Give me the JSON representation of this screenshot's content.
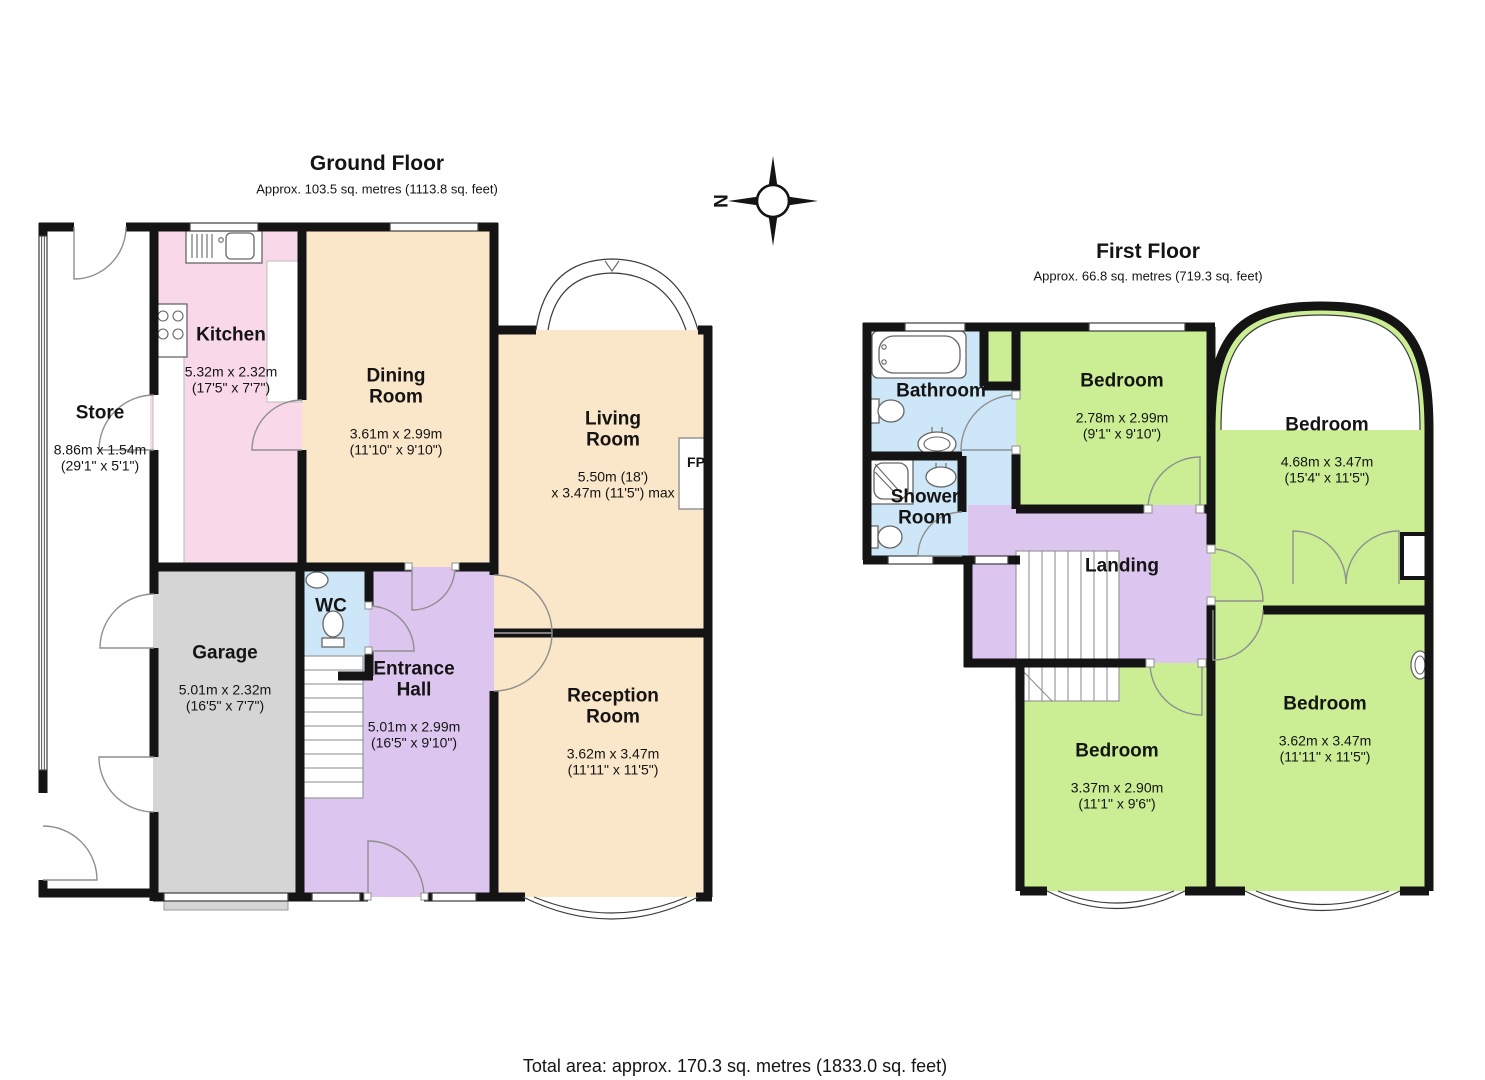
{
  "compass": {
    "north_label": "N"
  },
  "ground_floor": {
    "title": "Ground Floor",
    "subtitle": "Approx. 103.5 sq. metres (1113.8 sq. feet)",
    "rooms": {
      "store": {
        "name": "Store",
        "dims": "8.86m x 1.54m\n(29'1\" x 5'1\")"
      },
      "kitchen": {
        "name": "Kitchen",
        "dims": "5.32m x 2.32m\n(17'5\" x 7'7\")"
      },
      "dining_room": {
        "name": "Dining\nRoom",
        "dims": "3.61m x 2.99m\n(11'10\" x 9'10\")"
      },
      "living_room": {
        "name": "Living\nRoom",
        "dims": "5.50m (18')\nx 3.47m (11'5\") max"
      },
      "fireplace": {
        "name": "FP"
      },
      "garage": {
        "name": "Garage",
        "dims": "5.01m x 2.32m\n(16'5\" x 7'7\")"
      },
      "wc": {
        "name": "WC"
      },
      "entrance_hall": {
        "name": "Entrance\nHall",
        "dims": "5.01m x 2.99m\n(16'5\" x 9'10\")"
      },
      "reception_room": {
        "name": "Reception\nRoom",
        "dims": "3.62m x 3.47m\n(11'11\" x 11'5\")"
      }
    }
  },
  "first_floor": {
    "title": "First Floor",
    "subtitle": "Approx. 66.8 sq. metres (719.3 sq. feet)",
    "rooms": {
      "bathroom": {
        "name": "Bathroom"
      },
      "shower_room": {
        "name": "Shower\nRoom"
      },
      "landing": {
        "name": "Landing"
      },
      "bedroom_front": {
        "name": "Bedroom",
        "dims": "2.78m x 2.99m\n(9'1\" x 9'10\")"
      },
      "bedroom_right": {
        "name": "Bedroom",
        "dims": "4.68m x 3.47m\n(15'4\" x 11'5\")"
      },
      "bedroom_back_left": {
        "name": "Bedroom",
        "dims": "3.37m x 2.90m\n(11'1\" x 9'6\")"
      },
      "bedroom_back_right": {
        "name": "Bedroom",
        "dims": "3.62m x 3.47m\n(11'11\" x 11'5\")"
      }
    }
  },
  "footer": {
    "total_area": "Total area: approx. 170.3 sq. metres (1833.0 sq. feet)"
  },
  "colors": {
    "wall": "#141414",
    "beige": "#FAE6C9",
    "pink": "#F8D8E9",
    "purple": "#DCC6EF",
    "green": "#CBEE94",
    "blue": "#CDE7F8",
    "gray": "#D5D5D5"
  }
}
